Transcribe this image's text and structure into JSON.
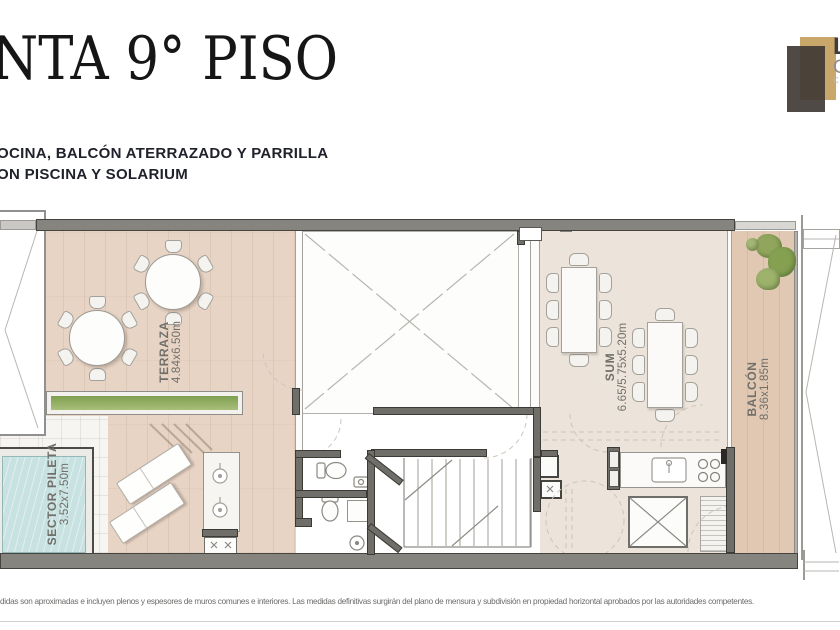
{
  "header": {
    "title": "NTA 9° PISO",
    "subtitle_line1": "OCINA, BALCÓN ATERRAZADO Y PARRILLA",
    "subtitle_line2": "ON PISCINA Y SOLARIUM"
  },
  "logo": {
    "text_line1": "L",
    "text_line2": "C",
    "text_line3": "CA",
    "color_tan": "#c9a76a",
    "color_dark": "#403b35"
  },
  "plan": {
    "rooms": [
      {
        "name": "TERRAZA",
        "dims": "4.84x6.50m"
      },
      {
        "name": "SUM",
        "dims": "6.65/5.75x5.20m"
      },
      {
        "name": "BALCÓN",
        "dims": "8.36x1.85m"
      },
      {
        "name": "SECTOR PILETA",
        "dims": "3.52x7.50m"
      }
    ]
  },
  "footer": {
    "disclaimer": "didas son aproximadas e incluyen plenos y espesores de muros comunes e interiores. Las medidas definitivas surgirán del plano de mensura y subdivisión en propiedad horizontal aprobados por las autoridades competentes."
  }
}
